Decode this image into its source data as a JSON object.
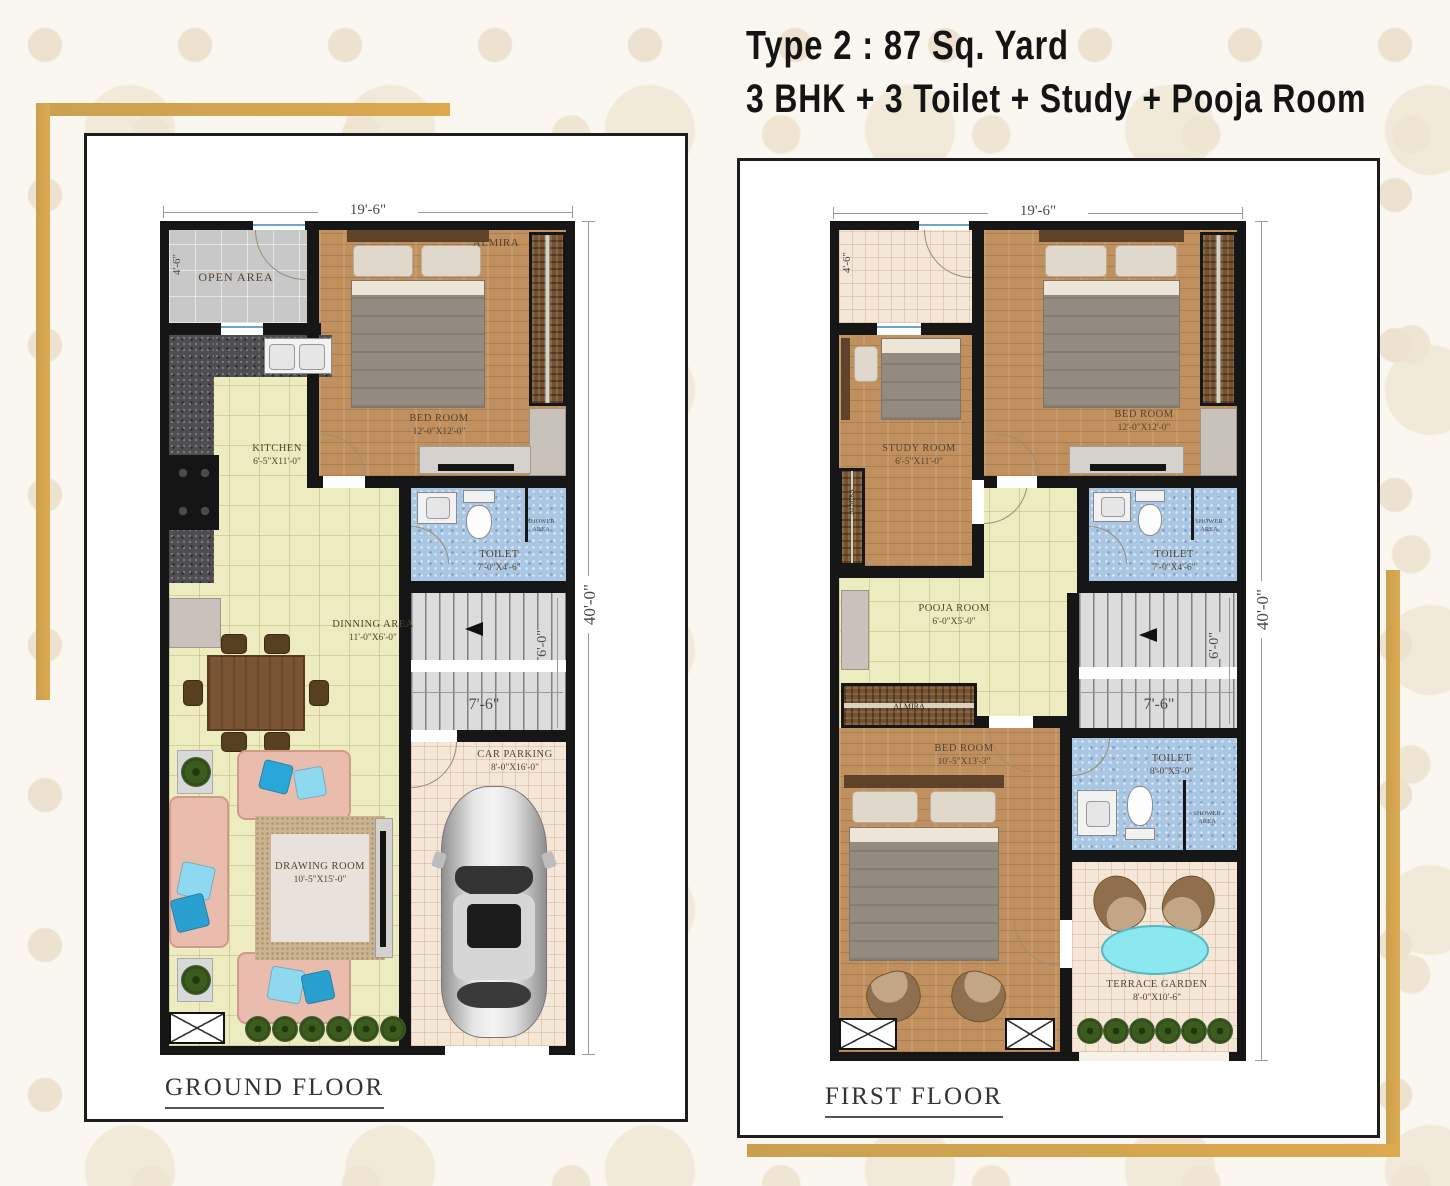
{
  "title": {
    "line1": "Type 2 : 87 Sq. Yard",
    "line2": "3 BHK + 3 Toilet + Study +  Pooja Room"
  },
  "colors": {
    "accent_gold": "#D9A14C",
    "wall_black": "#161616",
    "wood_floor": "#C0905E",
    "tile_yellow": "#EDEBC0",
    "toilet_blue": "#A9C6E3",
    "open_area_grey": "#C8C8C8",
    "parking_cream": "#F4E7D7",
    "sofa_pink": "#E9BCAE",
    "cushion_teal": "#29A7D8",
    "terrace_table_cyan": "#8CE8EF"
  },
  "floors": {
    "ground": {
      "name": "GROUND FLOOR",
      "width_dim": "19'-6\"",
      "height_dim": "40'-0\"",
      "side_dim": "4'-6\"",
      "stair_width": "7'-6\"",
      "stair_run": "6'-0\"",
      "open_area": "OPEN AREA",
      "almira_label": "ALMIRA",
      "shower": "SHOWER AREA",
      "bedroom": {
        "label": "BED ROOM",
        "size": "12'-0\"X12'-0\""
      },
      "kitchen": {
        "label": "KITCHEN",
        "size": "6'-5\"X11'-0\""
      },
      "toilet": {
        "label": "TOILET",
        "size": "7'-0\"X4'-6\""
      },
      "dining": {
        "label": "DINNING AREA",
        "size": "11'-0\"X6'-0\""
      },
      "drawing": {
        "label": "DRAWING ROOM",
        "size": "10'-5\"X15'-0\""
      },
      "parking": {
        "label": "CAR PARKING",
        "size": "8'-0\"X16'-0\""
      }
    },
    "first": {
      "name": "FIRST FLOOR",
      "width_dim": "19'-6\"",
      "height_dim": "40'-0\"",
      "side_dim": "4'-6\"",
      "stair_width": "7'-6\"",
      "stair_run": "6'-0\"",
      "almira_label": "ALMIRA",
      "shower": "SHOWER AREA",
      "study": {
        "label": "STUDY ROOM",
        "size": "6'-5\"X11'-0\""
      },
      "bedroom": {
        "label": "BED ROOM",
        "size": "12'-0\"X12'-0\""
      },
      "pooja": {
        "label": "POOJA ROOM",
        "size": "6'-0\"X5'-0\""
      },
      "toilet_top": {
        "label": "TOILET",
        "size": "7'-0\"X4'-6\""
      },
      "bedroom2": {
        "label": "BED ROOM",
        "size": "10'-5\"X13'-3\""
      },
      "toilet_bottom": {
        "label": "TOILET",
        "size": "8'-0\"X5'-0\""
      },
      "terrace": {
        "label": "TERRACE GARDEN",
        "size": "8'-0\"X10'-6\""
      }
    }
  }
}
